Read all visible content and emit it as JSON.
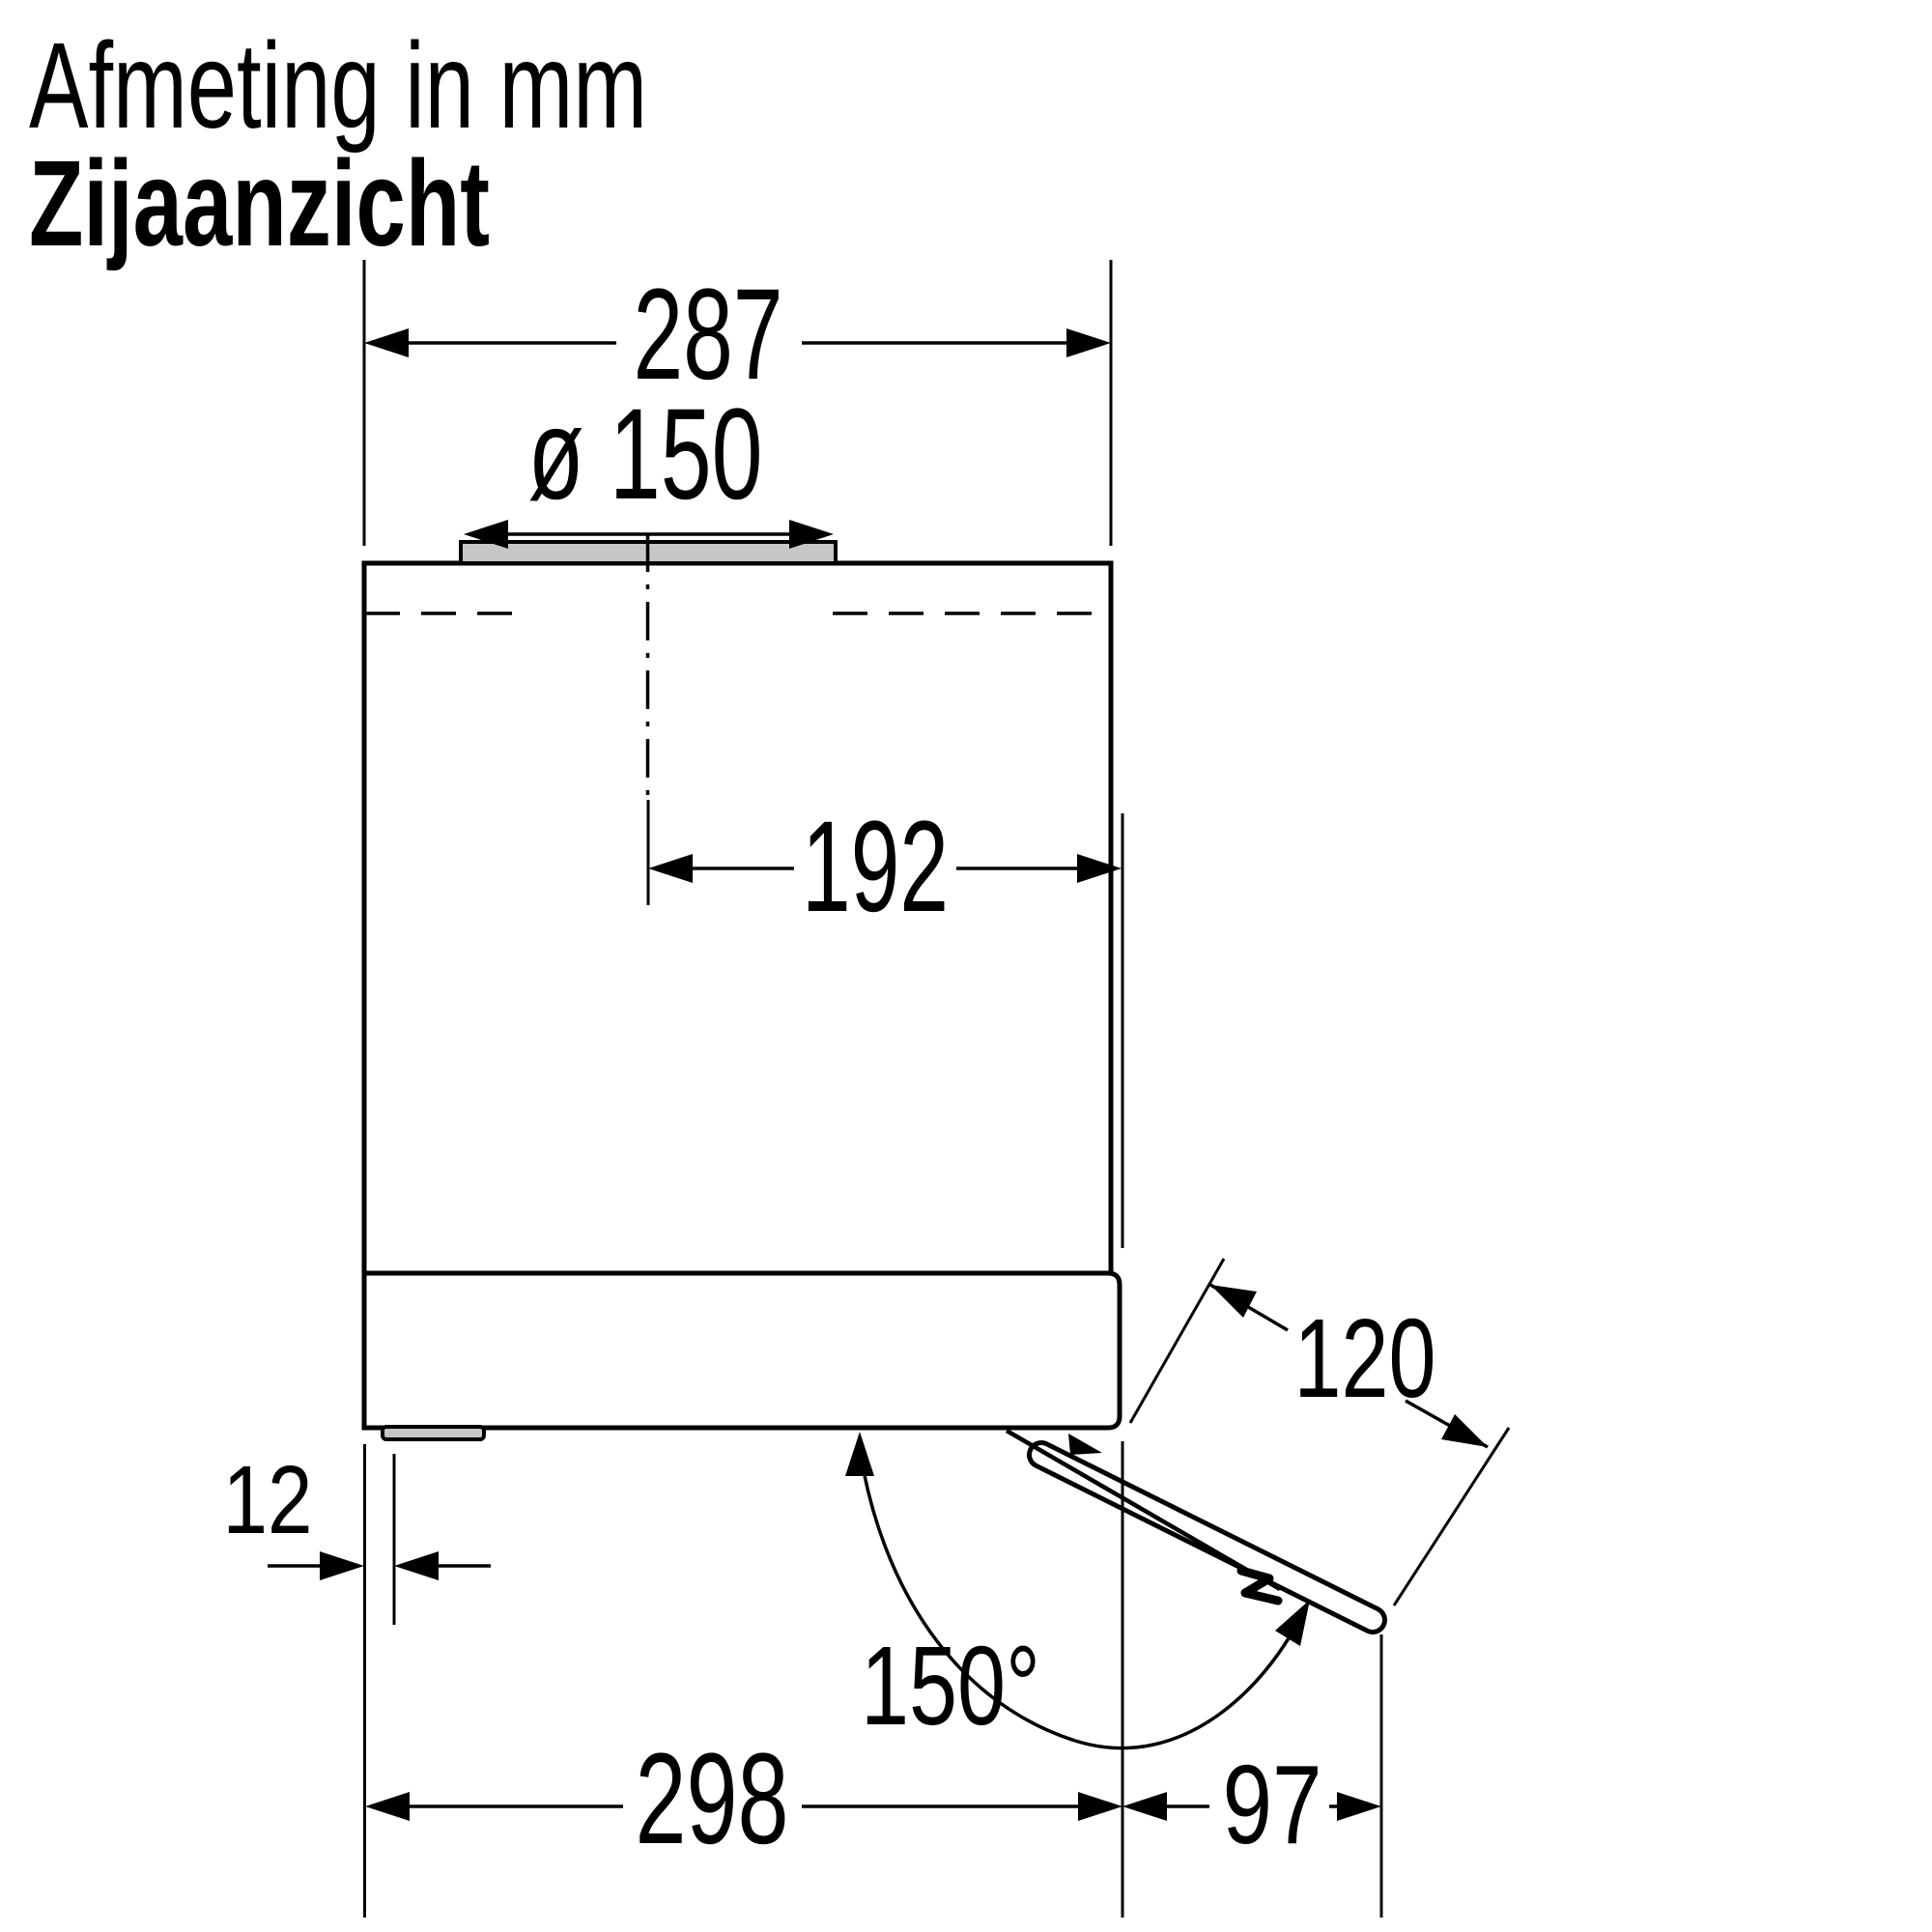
{
  "header": {
    "title": "Afmeting in mm",
    "subtitle": "Zijaanzicht"
  },
  "unit": "mm",
  "view": "side view",
  "colors": {
    "line": "#000000",
    "background": "#ffffff",
    "collar_fill": "#c6c6c6"
  },
  "dims": {
    "top_width": "287",
    "duct_diameter": "ø 150",
    "duct_offset": "192",
    "foot_inset": "12",
    "bottom_depth": "298",
    "flap_projection": "97",
    "flap_depth": "120",
    "opening_angle": "150°"
  }
}
